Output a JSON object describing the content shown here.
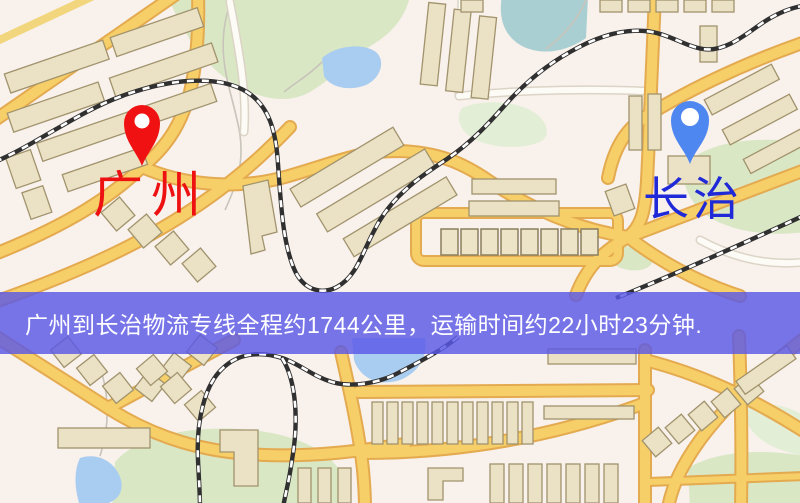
{
  "map": {
    "origin": {
      "label": "广州",
      "pin_color": "#f01212",
      "label_color": "#ee1111"
    },
    "destination": {
      "label": "长治",
      "pin_color": "#4f87f0",
      "label_color": "#2029d8"
    },
    "colors": {
      "background": "#f8f1ec",
      "road_major": "#f7cf68",
      "road_casing": "#e4aa50",
      "park": "#d9e7c5",
      "water": "#a9cdf0",
      "railway": "#303030",
      "building": "#ebe2c6"
    }
  },
  "banner": {
    "text": "广州到长治物流专线全程约1744公里，运输时间约22小时23分钟.",
    "distance_text": "约1744公里",
    "duration_text": "约22小时23分钟",
    "background_color": "rgba(90,88,230,0.82)",
    "text_color": "#ffffff"
  }
}
